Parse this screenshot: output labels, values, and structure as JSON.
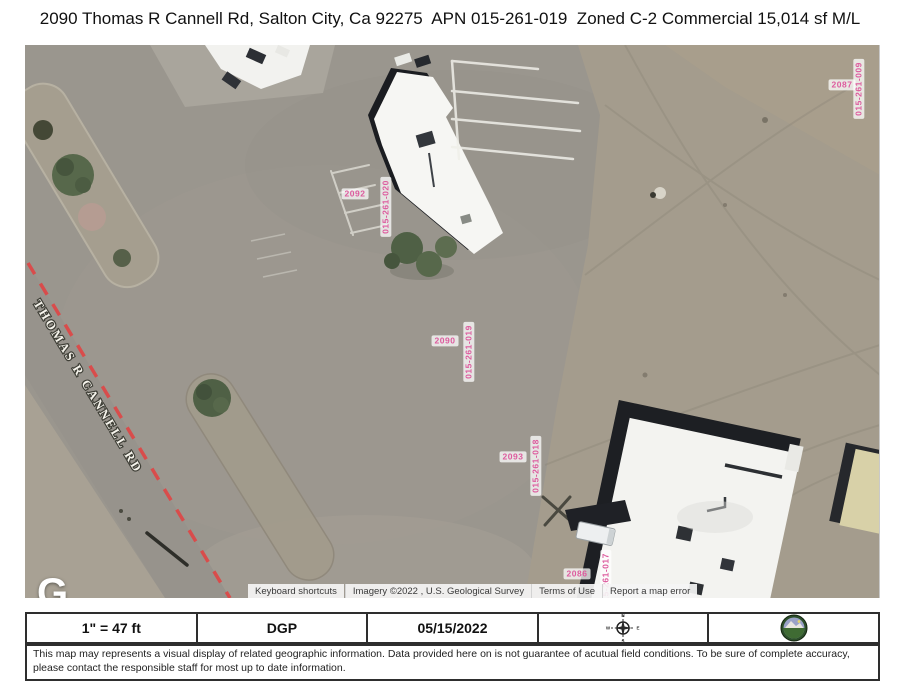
{
  "title": "2090 Thomas R Cannell Rd, Salton City, Ca 92275  APN 015-261-019  Zoned C-2 Commercial 15,014 sf M/L",
  "map": {
    "street_label": "THOMAS R CANNELL RD",
    "google_logo": "G",
    "label_color": "#dd5b9e",
    "parcels": [
      {
        "number": "2092",
        "apn": "015-261-020"
      },
      {
        "number": "2090",
        "apn": "015-261-019"
      },
      {
        "number": "2093",
        "apn": "015-261-018"
      },
      {
        "number": "2086",
        "apn": "015-261-017"
      },
      {
        "number": "2087",
        "apn": "015-261-009"
      }
    ],
    "attribution": {
      "keyboard_shortcuts": "Keyboard shortcuts",
      "imagery": "Imagery ©2022 , U.S. Geological Survey",
      "terms": "Terms of Use",
      "report_error": "Report a map error"
    }
  },
  "footer": {
    "scale": "1\" = 47 ft",
    "prepared_by": "DGP",
    "date": "05/15/2022",
    "compass": {
      "n": "N",
      "s": "S",
      "e": "E",
      "w": "W"
    },
    "disclaimer": "This map may represents a visual display of related geographic information. Data provided here on is not guarantee of acutual field conditions. To be sure of complete accuracy, please contact the responsible staff for most up to date information."
  }
}
